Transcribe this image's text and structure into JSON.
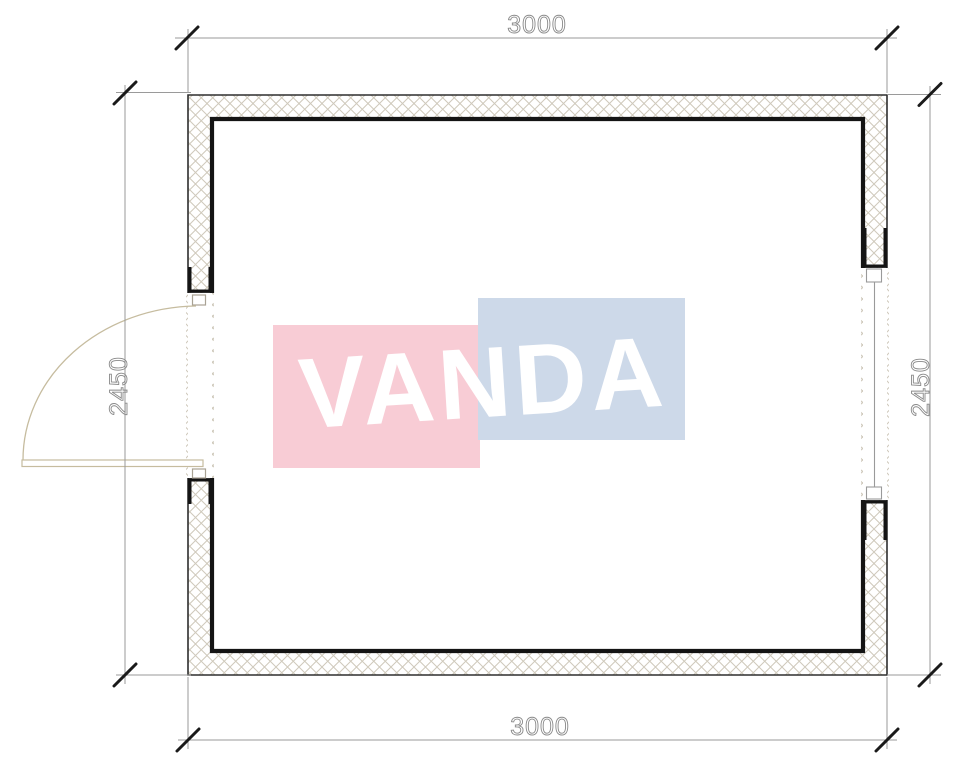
{
  "watermark": {
    "text": "VANDA",
    "pink_color": "#f8ccd5",
    "blue_color": "#cdd9e9",
    "text_color": "#ffffff"
  },
  "dimensions": {
    "top_label": "3000",
    "bottom_label": "3000",
    "left_label": "2450",
    "right_label": "2450"
  },
  "colors": {
    "wall_line": "#141414",
    "wall_outline": "#2e2e2e",
    "hatch_line": "#cfc9bb",
    "dimension_line": "#9a9a9a",
    "dimension_text": "#8a8a8a",
    "tick": "#1a1a1a",
    "door_line": "#c6bc9f",
    "window_line": "#9a9a9a"
  }
}
